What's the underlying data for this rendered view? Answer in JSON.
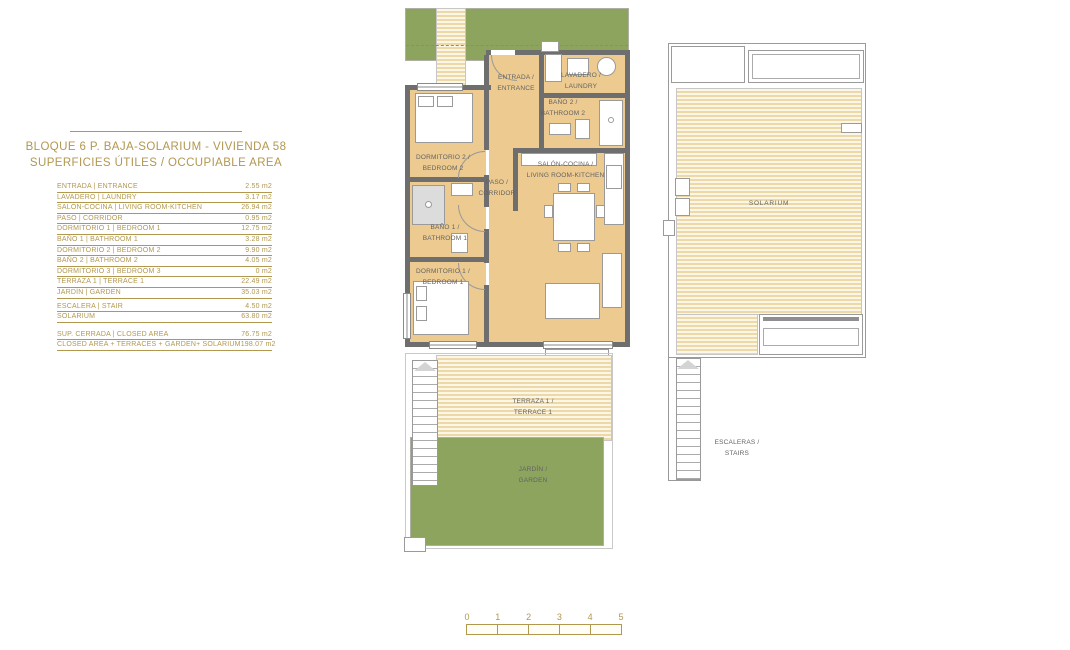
{
  "title": {
    "line1": "BLOQUE 6 P. BAJA-SOLARIUM - VIVIENDA 58",
    "line2": "SUPERFICIES ÚTILES / OCCUPIABLE AREA"
  },
  "area_table": {
    "main_rows": [
      {
        "label": "ENTRADA | ENTRANCE",
        "value": "2.55 m2"
      },
      {
        "label": "LAVADERO | LAUNDRY",
        "value": "3.17 m2"
      },
      {
        "label": "SALÓN-COCINA | LIVING ROOM-KITCHEN",
        "value": "26.94 m2"
      },
      {
        "label": "PASO | CORRIDOR",
        "value": "0.95 m2"
      },
      {
        "label": "DORMITORIO 1 | BEDROOM 1",
        "value": "12.75 m2"
      },
      {
        "label": "BAÑO 1 | BATHROOM 1",
        "value": "3.28 m2"
      },
      {
        "label": "DORMITORIO 2 | BEDROOM 2",
        "value": "9.90 m2"
      },
      {
        "label": "BAÑO 2 | BATHROOM 2",
        "value": "4.05 m2"
      },
      {
        "label": "DORMITORIO 3 | BEDROOM 3",
        "value": "0 m2"
      },
      {
        "label": "TERRAZA 1 | TERRACE 1",
        "value": "22.49 m2"
      },
      {
        "label": "JARDÍN | GARDEN",
        "value": "35.03 m2"
      }
    ],
    "extra_rows": [
      {
        "label": "ESCALERA | STAIR",
        "value": "4.50 m2"
      },
      {
        "label": "SOLARIUM",
        "value": "63.80 m2"
      }
    ],
    "summary_rows": [
      {
        "label": "SUP. CERRADA | CLOSED AREA",
        "value": "76.75 m2"
      },
      {
        "label": "CLOSED AREA + TERRACES + GARDEN+ SOLARIUM",
        "value": "198.07 m2"
      }
    ]
  },
  "plan_labels": {
    "entrance": "ENTRADA /\nENTRANCE",
    "laundry": "LAVADERO /\nLAUNDRY",
    "bathroom2": "BAÑO 2 /\nBATHROOM 2",
    "bedroom2": "DORMITORIO 2 /\nBEDROOM 2",
    "corridor": "PASO /\nCORRIDOR",
    "living": "SALÓN-COCINA /\nLIVING ROOM-KITCHEN",
    "bathroom1": "BAÑO 1 /\nBATHROOM 1",
    "bedroom1": "DORMITORIO 1 /\nBEDROOM 1",
    "terrace": "TERRAZA 1 /\nTERRACE 1",
    "garden": "JARDÍN /\nGARDEN"
  },
  "solarium_labels": {
    "solarium": "SOLARIUM",
    "stairs": "ESCALERAS /\nSTAIRS"
  },
  "scale_bar": {
    "numbers": [
      "0",
      "1",
      "2",
      "3",
      "4",
      "5"
    ]
  },
  "colors": {
    "accent_gold": "#B2974F",
    "garden_green": "#8CA45E",
    "floor_tan": "#ECCA90",
    "wall_gray": "#6E6E6E",
    "stripe_cream": "#ECD9A7",
    "label_gray": "#636363"
  }
}
